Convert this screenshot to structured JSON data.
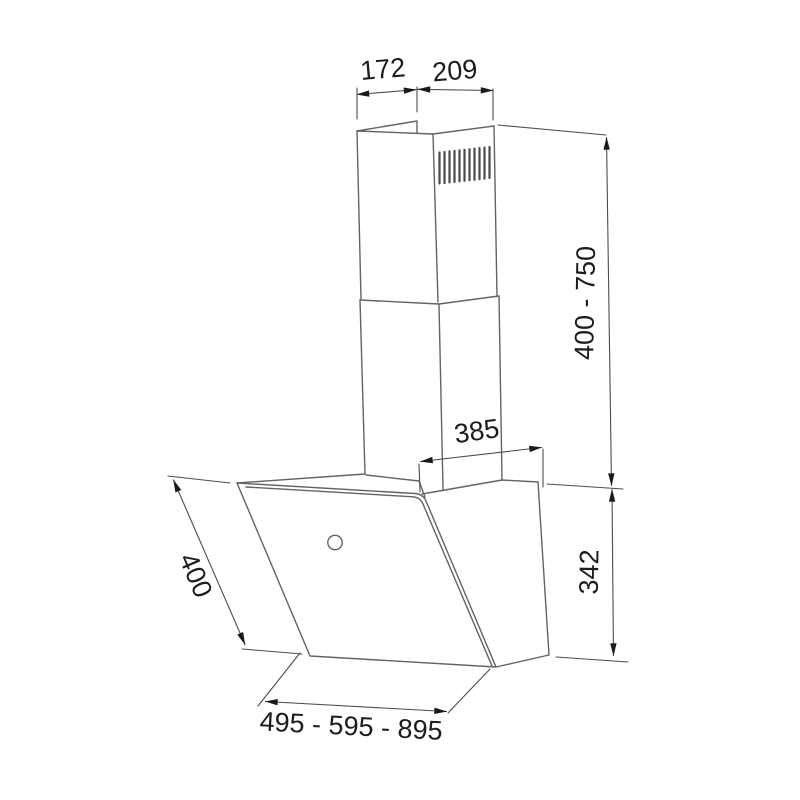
{
  "page": {
    "background": "#ffffff"
  },
  "drawing": {
    "subject": "wall-mounted chimney cooker hood dimension drawing",
    "labels": {
      "chimney_top_depth": "172",
      "chimney_top_width": "209",
      "chimney_height_range": "400 - 750",
      "chimney_base_width": "385",
      "hood_body_height": "342",
      "hood_panel_depth": "400",
      "hood_width_variants": "495 - 595 - 895"
    },
    "colors": {
      "outline": "#636363",
      "dimension_line": "#4d4d4d",
      "arrow": "#1a1a1a",
      "label_text": "#1c1c1c",
      "background": "#ffffff"
    }
  }
}
